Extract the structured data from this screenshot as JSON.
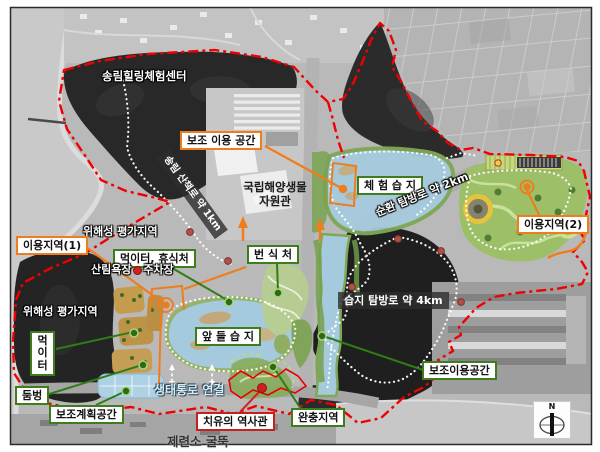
{
  "area_labels": {
    "songrim_center": "송림힐링체험센터",
    "wihaeseong_upper": "위해성 평가지역",
    "wihaeseong_lower": "위해성 평가지역",
    "sanrim_parking": "산림욕장 · 주차장",
    "saengtae_corridor": "생태통로 연결",
    "jeryeonso_chimney": "제련소 굴뚝",
    "gungnip_line1": "국립해양생물",
    "gungnip_line2": "자원관"
  },
  "boxed_labels": {
    "bojo_iyong_gonggan": "보조 이용 공간",
    "iyong_area1": "이용지역(1)",
    "iyong_area2": "이용지역(2)",
    "meogi_hyusik": "먹이터, 휴식처",
    "beonsikcheo": "번 식 처",
    "cheheom_wetland": "체 험 습 지",
    "apdeul_wetland": "앞 들 습 지",
    "meogiteo": "먹이터",
    "dumbeong": "둠벙",
    "bojo_plan_space": "보조계획공간",
    "bojo_iyong_space": "보조이용공간",
    "wanchung_area": "완충지역",
    "chiyu_history": "치유의 역사관"
  },
  "path_labels": {
    "songrim_trail": "송림 산책로 약 1km",
    "sunhwan_trail": "순환 탐방로 약 2km",
    "seupji_trail": "습지 탐방로 약 4km"
  },
  "compass": {
    "north": "N"
  },
  "colors": {
    "boundary_red": "#f00000",
    "orange_accent": "#ee7d1c",
    "green_accent": "#2e7d18",
    "red_accent": "#cf1f1f",
    "wetland_blue": "#a6cadd",
    "park_green": "#9cbf68",
    "forest_dark": "#262626"
  }
}
